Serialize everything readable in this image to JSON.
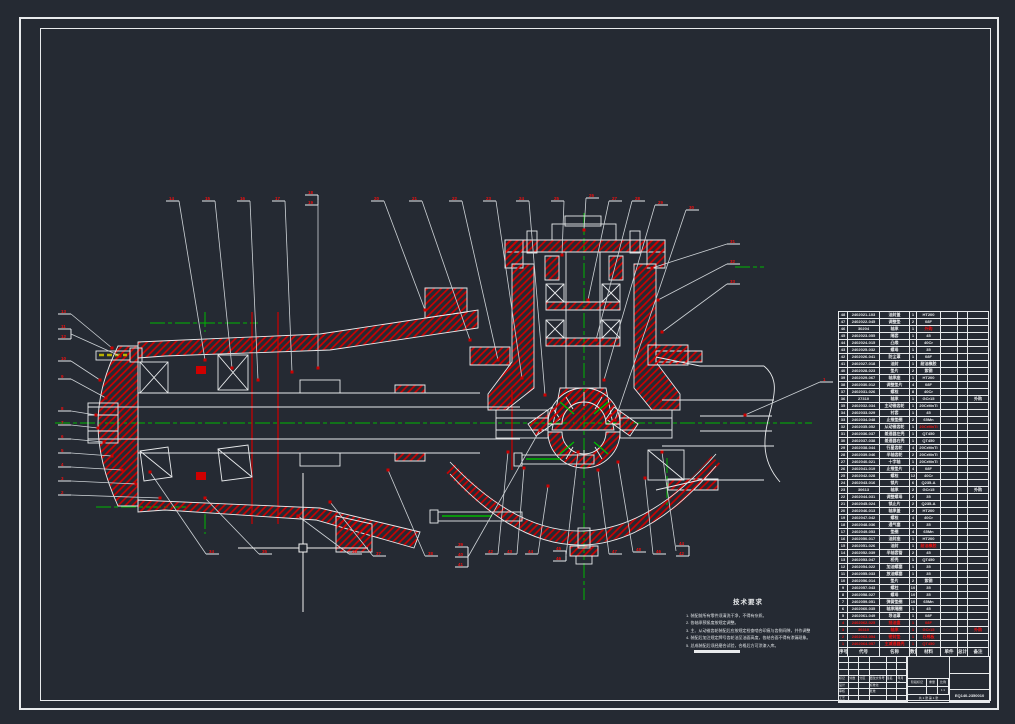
{
  "colors": {
    "background": "#252a33",
    "line": "#e8eaec",
    "hatch_red": "#cf0000",
    "callout_red": "#ef1010",
    "centerline_green": "#00b800",
    "bolt_yellow": "#b8b000"
  },
  "notes": {
    "title": "技术要求",
    "items": [
      "1. 装配前所有零件须清洗干净，不得有杂质。",
      "2. 各轴承预紧度按规定调整。",
      "3. 主、从动锥齿轮装配后应按规定检查啮合印痕与齿侧间隙，并作调整记录。",
      "4. 装配后加注规定牌号齿轮油至油面高度，各结合面不得有渗漏现象。",
      "5. 总成装配后须经磨合试验，合格后方可涂漆入库。"
    ]
  },
  "bom": {
    "headers": [
      "序号",
      "代号",
      "名称",
      "数量",
      "材料",
      "单件",
      "总计",
      "备注"
    ],
    "red_rows": [
      44,
      45,
      46,
      47
    ],
    "red_material_rows": [
      2,
      16,
      33
    ],
    "rows": [
      [
        "48",
        "2402021-103",
        "油封盖",
        "1",
        "HT200",
        "",
        "",
        ""
      ],
      [
        "47",
        "2402022-045",
        "调整垫",
        "2",
        "08F",
        "",
        "",
        ""
      ],
      [
        "46",
        "30204",
        "轴承",
        "1",
        "外购",
        "",
        "",
        ""
      ],
      [
        "45",
        "2402023-055",
        "隔套",
        "1",
        "45",
        "",
        "",
        ""
      ],
      [
        "44",
        "2402024-015",
        "凸缘",
        "1",
        "40Cr",
        "",
        "",
        ""
      ],
      [
        "43",
        "2402025-032",
        "螺母",
        "1",
        "35",
        "",
        "",
        ""
      ],
      [
        "42",
        "2402026-041",
        "防尘罩",
        "1",
        "08F",
        "",
        "",
        ""
      ],
      [
        "41",
        "2402027-018",
        "油封",
        "1",
        "耐油橡胶",
        "",
        "",
        ""
      ],
      [
        "40",
        "2402028-023",
        "垫片",
        "2",
        "紫铜",
        "",
        "",
        ""
      ],
      [
        "39",
        "2402029-067",
        "轴承座",
        "1",
        "HT200",
        "",
        "",
        ""
      ],
      [
        "38",
        "2402030-012",
        "调整垫片",
        "4",
        "08F",
        "",
        "",
        ""
      ],
      [
        "37",
        "2402031-026",
        "螺栓",
        "8",
        "40Cr",
        "",
        "",
        ""
      ],
      [
        "36",
        "27310",
        "轴承",
        "1",
        "GCr15",
        "",
        "",
        "外购"
      ],
      [
        "35",
        "2402032-034",
        "主动锥齿轮",
        "1",
        "20CrMnTi",
        "",
        "",
        ""
      ],
      [
        "34",
        "2402033-029",
        "衬套",
        "1",
        "45",
        "",
        "",
        ""
      ],
      [
        "33",
        "2402034-048",
        "止推垫圈",
        "2",
        "65Mn",
        "",
        "",
        ""
      ],
      [
        "32",
        "2402035-052",
        "从动锥齿轮",
        "1",
        "20CrMnTi",
        "",
        "",
        ""
      ],
      [
        "31",
        "2402036-037",
        "差速器左壳",
        "1",
        "QT450",
        "",
        "",
        ""
      ],
      [
        "30",
        "2402037-038",
        "差速器右壳",
        "1",
        "QT450",
        "",
        "",
        ""
      ],
      [
        "29",
        "2402038-044",
        "行星齿轮",
        "4",
        "20CrMnTi",
        "",
        "",
        ""
      ],
      [
        "28",
        "2402039-046",
        "半轴齿轮",
        "2",
        "20CrMnTi",
        "",
        "",
        ""
      ],
      [
        "27",
        "2402040-021",
        "十字轴",
        "1",
        "20CrMnTi",
        "",
        "",
        ""
      ],
      [
        "26",
        "2402041-019",
        "止推垫片",
        "4",
        "08F",
        "",
        "",
        ""
      ],
      [
        "25",
        "2402042-028",
        "螺栓",
        "12",
        "40Cr",
        "",
        "",
        ""
      ],
      [
        "24",
        "2402043-016",
        "锁片",
        "6",
        "Q235-A",
        "",
        "",
        ""
      ],
      [
        "23",
        "30613",
        "轴承",
        "2",
        "GCr15",
        "",
        "",
        "外购"
      ],
      [
        "22",
        "2402044-031",
        "调整螺母",
        "2",
        "35",
        "",
        "",
        ""
      ],
      [
        "21",
        "2402045-024",
        "锁止片",
        "2",
        "Q235-A",
        "",
        "",
        ""
      ],
      [
        "20",
        "2402046-013",
        "轴承盖",
        "2",
        "HT200",
        "",
        "",
        ""
      ],
      [
        "19",
        "2402047-042",
        "螺栓",
        "4",
        "40Cr",
        "",
        "",
        ""
      ],
      [
        "18",
        "2402048-036",
        "通气塞",
        "1",
        "35",
        "",
        "",
        ""
      ],
      [
        "17",
        "2402049-053",
        "垫圈",
        "4",
        "65Mn",
        "",
        "",
        ""
      ],
      [
        "16",
        "2402050-017",
        "油封座",
        "1",
        "HT200",
        "",
        "",
        ""
      ],
      [
        "15",
        "2402051-026",
        "油封",
        "1",
        "耐油橡胶",
        "",
        "",
        ""
      ],
      [
        "14",
        "2402052-039",
        "半轴套管",
        "2",
        "45",
        "",
        "",
        ""
      ],
      [
        "13",
        "2402053-047",
        "桥壳",
        "1",
        "QT450",
        "",
        "",
        ""
      ],
      [
        "12",
        "2402054-022",
        "加油螺塞",
        "1",
        "35",
        "",
        "",
        ""
      ],
      [
        "11",
        "2402055-033",
        "放油螺塞",
        "1",
        "35",
        "",
        "",
        ""
      ],
      [
        "10",
        "2402056-014",
        "垫片",
        "2",
        "紫铜",
        "",
        "",
        ""
      ],
      [
        "9",
        "2402057-043",
        "螺柱",
        "10",
        "35",
        "",
        "",
        ""
      ],
      [
        "8",
        "2402058-027",
        "螺母",
        "10",
        "35",
        "",
        "",
        ""
      ],
      [
        "7",
        "2402059-051",
        "弹簧垫圈",
        "10",
        "65Mn",
        "",
        "",
        ""
      ],
      [
        "6",
        "2402060-035",
        "轴承隔圈",
        "1",
        "45",
        "",
        "",
        ""
      ],
      [
        "5",
        "2402061-049",
        "导油罩",
        "1",
        "08F",
        "",
        "",
        ""
      ],
      [
        "4",
        "2402062-025",
        "挡油盘",
        "1",
        "08F",
        "",
        "",
        ""
      ],
      [
        "3",
        "30310",
        "轴承",
        "1",
        "GCr15",
        "",
        "",
        "外购"
      ],
      [
        "2",
        "2402063-054",
        "密封垫",
        "1",
        "石棉板",
        "",
        "",
        ""
      ],
      [
        "1",
        "2402064-057",
        "主减速器壳",
        "1",
        "QT450",
        "",
        "",
        ""
      ]
    ]
  },
  "title_block": {
    "left_cells": {
      "18": "标记",
      "19": "处数",
      "20": "分区",
      "21": "更改文件号",
      "22": "签名",
      "23": "年月日",
      "24": "设计",
      "27": "标准化",
      "30": "审核",
      "33": "批准",
      "36": "工艺"
    },
    "stage_label": "阶段标记",
    "weight_label": "重量",
    "scale_label": "比例",
    "scale": "1:1",
    "sheet": "共 1 张 第 1 张",
    "drawing_no": "EQ140-2350010"
  },
  "drawing": {
    "cursor": {
      "x": 303,
      "y": 548
    },
    "callouts": [
      {
        "x": 166,
        "y": 197,
        "n": [
          "14"
        ],
        "t": [
          205,
          360
        ]
      },
      {
        "x": 202,
        "y": 197,
        "n": [
          "15"
        ],
        "t": [
          232,
          368
        ]
      },
      {
        "x": 237,
        "y": 197,
        "n": [
          "16"
        ],
        "t": [
          258,
          380
        ]
      },
      {
        "x": 272,
        "y": 197,
        "n": [
          "17"
        ],
        "t": [
          292,
          372
        ]
      },
      {
        "x": 305,
        "y": 191,
        "n": [
          "18",
          "19"
        ],
        "t": [
          318,
          368
        ]
      },
      {
        "x": 371,
        "y": 197,
        "n": [
          "20"
        ],
        "t": [
          425,
          310
        ]
      },
      {
        "x": 409,
        "y": 197,
        "n": [
          "21"
        ],
        "t": [
          470,
          340
        ]
      },
      {
        "x": 449,
        "y": 197,
        "n": [
          "22"
        ],
        "t": [
          498,
          360
        ]
      },
      {
        "x": 483,
        "y": 197,
        "n": [
          "23"
        ],
        "t": [
          522,
          378
        ]
      },
      {
        "x": 516,
        "y": 197,
        "n": [
          "24"
        ],
        "t": [
          545,
          395
        ]
      },
      {
        "x": 551,
        "y": 197,
        "n": [
          "25"
        ],
        "t": [
          562,
          255
        ]
      },
      {
        "x": 586,
        "y": 194,
        "n": [
          "26"
        ],
        "t": [
          584,
          230
        ]
      },
      {
        "x": 609,
        "y": 197,
        "n": [
          "27"
        ],
        "t": [
          588,
          300
        ]
      },
      {
        "x": 632,
        "y": 197,
        "n": [
          "28"
        ],
        "t": [
          596,
          340
        ]
      },
      {
        "x": 655,
        "y": 201,
        "n": [
          "29"
        ],
        "t": [
          604,
          380
        ]
      },
      {
        "x": 686,
        "y": 206,
        "n": [
          "30"
        ],
        "t": [
          615,
          420
        ]
      },
      {
        "x": 727,
        "y": 240,
        "n": [
          "31"
        ],
        "t": [
          652,
          268
        ]
      },
      {
        "x": 727,
        "y": 260,
        "n": [
          "32"
        ],
        "t": [
          658,
          300
        ]
      },
      {
        "x": 727,
        "y": 280,
        "n": [
          "33"
        ],
        "t": [
          662,
          332
        ]
      },
      {
        "x": 820,
        "y": 378,
        "n": [
          "1"
        ],
        "t": [
          745,
          415
        ]
      },
      {
        "x": 58,
        "y": 310,
        "n": [
          "13"
        ],
        "t": [
          112,
          348
        ]
      },
      {
        "x": 58,
        "y": 325,
        "n": [
          "11",
          "12"
        ],
        "t": [
          120,
          356
        ]
      },
      {
        "x": 58,
        "y": 357,
        "n": [
          "10"
        ],
        "t": [
          100,
          380
        ]
      },
      {
        "x": 58,
        "y": 375,
        "n": [
          "9"
        ],
        "t": [
          106,
          398
        ]
      },
      {
        "x": 58,
        "y": 407,
        "n": [
          "8"
        ],
        "t": [
          96,
          415
        ]
      },
      {
        "x": 58,
        "y": 421,
        "n": [
          "7"
        ],
        "t": [
          98,
          428
        ]
      },
      {
        "x": 58,
        "y": 435,
        "n": [
          "6"
        ],
        "t": [
          104,
          442
        ]
      },
      {
        "x": 58,
        "y": 449,
        "n": [
          "5"
        ],
        "t": [
          112,
          456
        ]
      },
      {
        "x": 58,
        "y": 463,
        "n": [
          "4"
        ],
        "t": [
          122,
          470
        ]
      },
      {
        "x": 58,
        "y": 477,
        "n": [
          "3"
        ],
        "t": [
          136,
          484
        ]
      },
      {
        "x": 58,
        "y": 491,
        "n": [
          "2"
        ],
        "t": [
          160,
          498
        ]
      },
      {
        "x": 206,
        "y": 550,
        "n": [
          "34"
        ],
        "t": [
          150,
          472
        ]
      },
      {
        "x": 259,
        "y": 550,
        "n": [
          "35"
        ],
        "t": [
          205,
          498
        ]
      },
      {
        "x": 349,
        "y": 550,
        "n": [
          "36"
        ],
        "t": [
          298,
          516
        ]
      },
      {
        "x": 373,
        "y": 552,
        "n": [
          "37"
        ],
        "t": [
          330,
          502
        ]
      },
      {
        "x": 425,
        "y": 552,
        "n": [
          "38"
        ],
        "t": [
          388,
          470
        ]
      },
      {
        "x": 455,
        "y": 543,
        "n": [
          "39",
          "40",
          "41"
        ],
        "t": [
          540,
          430
        ]
      },
      {
        "x": 485,
        "y": 550,
        "n": [
          "42"
        ],
        "t": [
          508,
          452
        ]
      },
      {
        "x": 504,
        "y": 550,
        "n": [
          "43"
        ],
        "t": [
          524,
          468
        ]
      },
      {
        "x": 525,
        "y": 550,
        "n": [
          "44"
        ],
        "t": [
          548,
          486
        ]
      },
      {
        "x": 553,
        "y": 547,
        "n": [
          "45",
          "46"
        ],
        "t": [
          578,
          452
        ]
      },
      {
        "x": 609,
        "y": 550,
        "n": [
          "47"
        ],
        "t": [
          598,
          470
        ]
      },
      {
        "x": 633,
        "y": 548,
        "n": [
          "48"
        ],
        "t": [
          618,
          462
        ]
      },
      {
        "x": 653,
        "y": 550,
        "n": [
          "46"
        ],
        "t": [
          645,
          478
        ]
      },
      {
        "x": 676,
        "y": 542,
        "n": [
          "44",
          "42"
        ],
        "t": [
          662,
          452
        ]
      }
    ]
  }
}
